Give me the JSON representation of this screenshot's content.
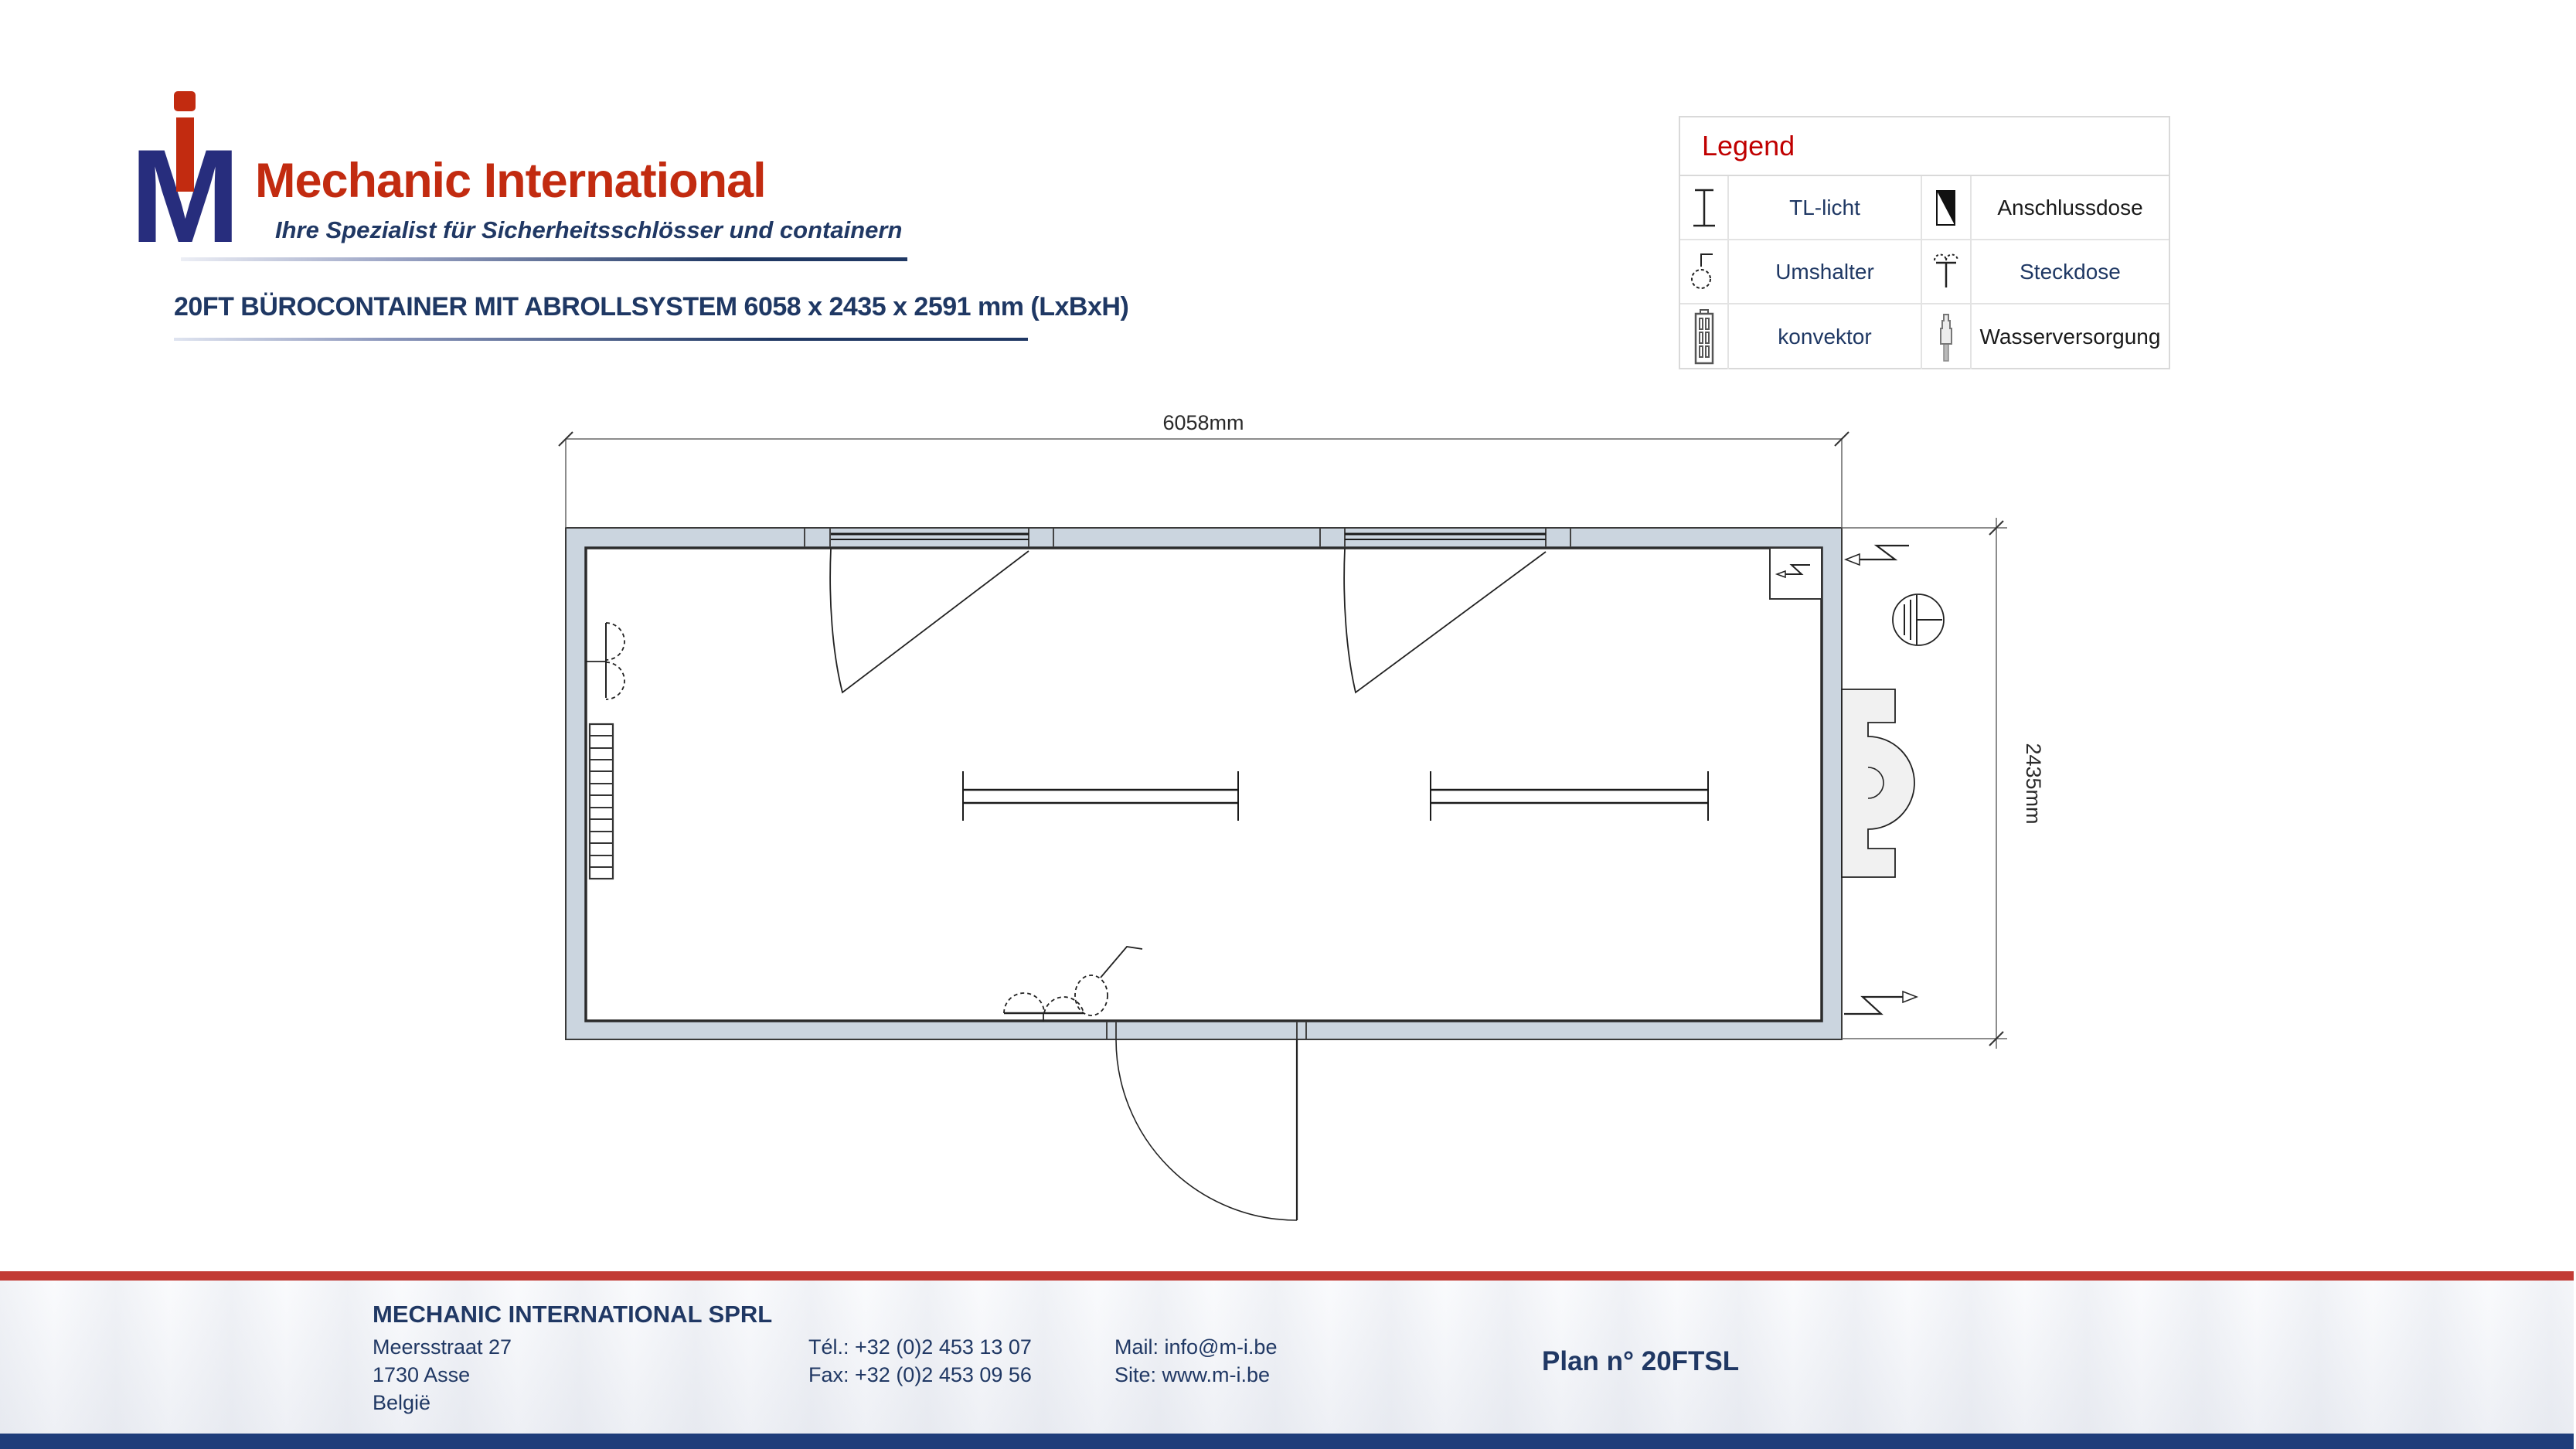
{
  "logo": {
    "monogram_m": "M",
    "brand": "Mechanic International",
    "tagline": "Ihre Spezialist für Sicherheitsschlösser und containern"
  },
  "title": {
    "text": "20FT BÜROCONTAINER MIT ABROLLSYSTEM 6058 x 2435 x 2591 mm (LxBxH)"
  },
  "legend": {
    "header": "Legend",
    "items": [
      {
        "icon": "tl-licht-icon",
        "label": "TL-licht",
        "color": "#1F3864"
      },
      {
        "icon": "anschlussdose-icon",
        "label": "Anschlussdose",
        "color": "#1a1a1a"
      },
      {
        "icon": "umshalter-icon",
        "label": "Umshalter",
        "color": "#1F3864"
      },
      {
        "icon": "steckdose-icon",
        "label": "Steckdose",
        "color": "#1F3864"
      },
      {
        "icon": "konvektor-icon",
        "label": "konvektor",
        "color": "#1F3864"
      },
      {
        "icon": "wasserversorgung-icon",
        "label": "Wasserversorgung",
        "color": "#1a1a1a"
      }
    ]
  },
  "plan": {
    "length_label": "6058mm",
    "width_label": "2435mm"
  },
  "footer": {
    "company": "MECHANIC INTERNATIONAL SPRL",
    "address_line1": "Meersstraat 27",
    "address_line2": "1730 Asse",
    "address_line3": "België",
    "phone": "Tél.: +32 (0)2 453 13 07",
    "fax": "Fax: +32 (0)2 453 09 56",
    "mail": "Mail: info@m-i.be",
    "site": "Site: www.m-i.be",
    "plan_number": "Plan n° 20FTSL"
  },
  "colors": {
    "brand_red": "#C22B10",
    "legend_red": "#C00000",
    "navy": "#1F3864",
    "logo_blue": "#272D7D",
    "wall_fill": "#CBD5DF",
    "footer_red_bar": "#C23B35",
    "footer_blue_bar": "#1F3D7A"
  }
}
